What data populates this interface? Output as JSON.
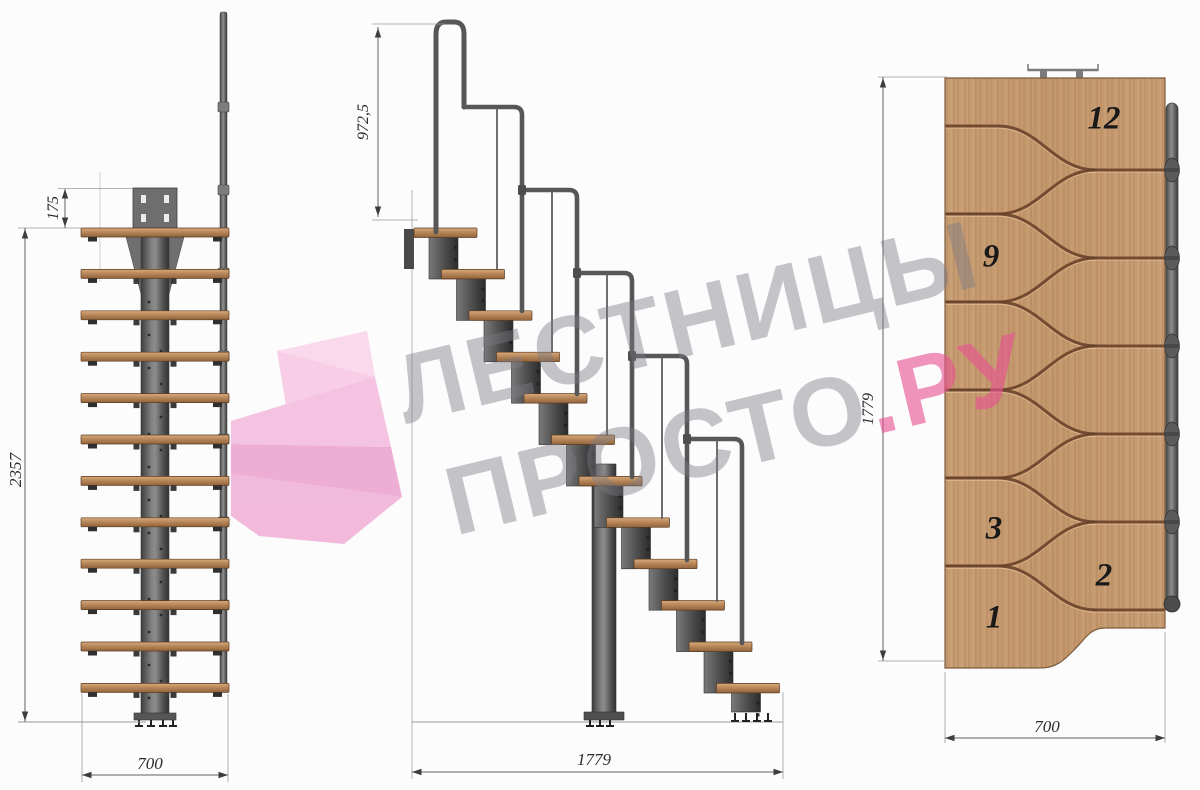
{
  "watermark": {
    "line1": "ЛЕСТНИЦЫ",
    "brand_gray": "ПРОСТО",
    "brand_dot": ".",
    "brand_pink": "РУ"
  },
  "dimensions": {
    "plate_offset": "175",
    "total_height": "2357",
    "stair_width_front": "700",
    "handrail_height": "972,5",
    "stair_length_side": "1779",
    "plan_length": "1779",
    "plan_width": "700"
  },
  "plan": {
    "step_numbers": [
      "12",
      "9",
      "3",
      "2",
      "1"
    ]
  },
  "structure": {
    "step_count": 12,
    "handrail_segment_count": 5,
    "collar_ys": [
      107,
      190,
      273,
      356,
      439,
      522,
      605
    ],
    "plan_neck_ys": [
      170,
      258,
      346,
      434,
      522,
      610
    ],
    "plan_spindle_ys": [
      170,
      258,
      346,
      434,
      522
    ]
  },
  "colors": {
    "accent_pink": "#e85a96",
    "logo_pink": "#f3bada",
    "wood": "#c49a6f",
    "metal": "#5a5a5a"
  }
}
